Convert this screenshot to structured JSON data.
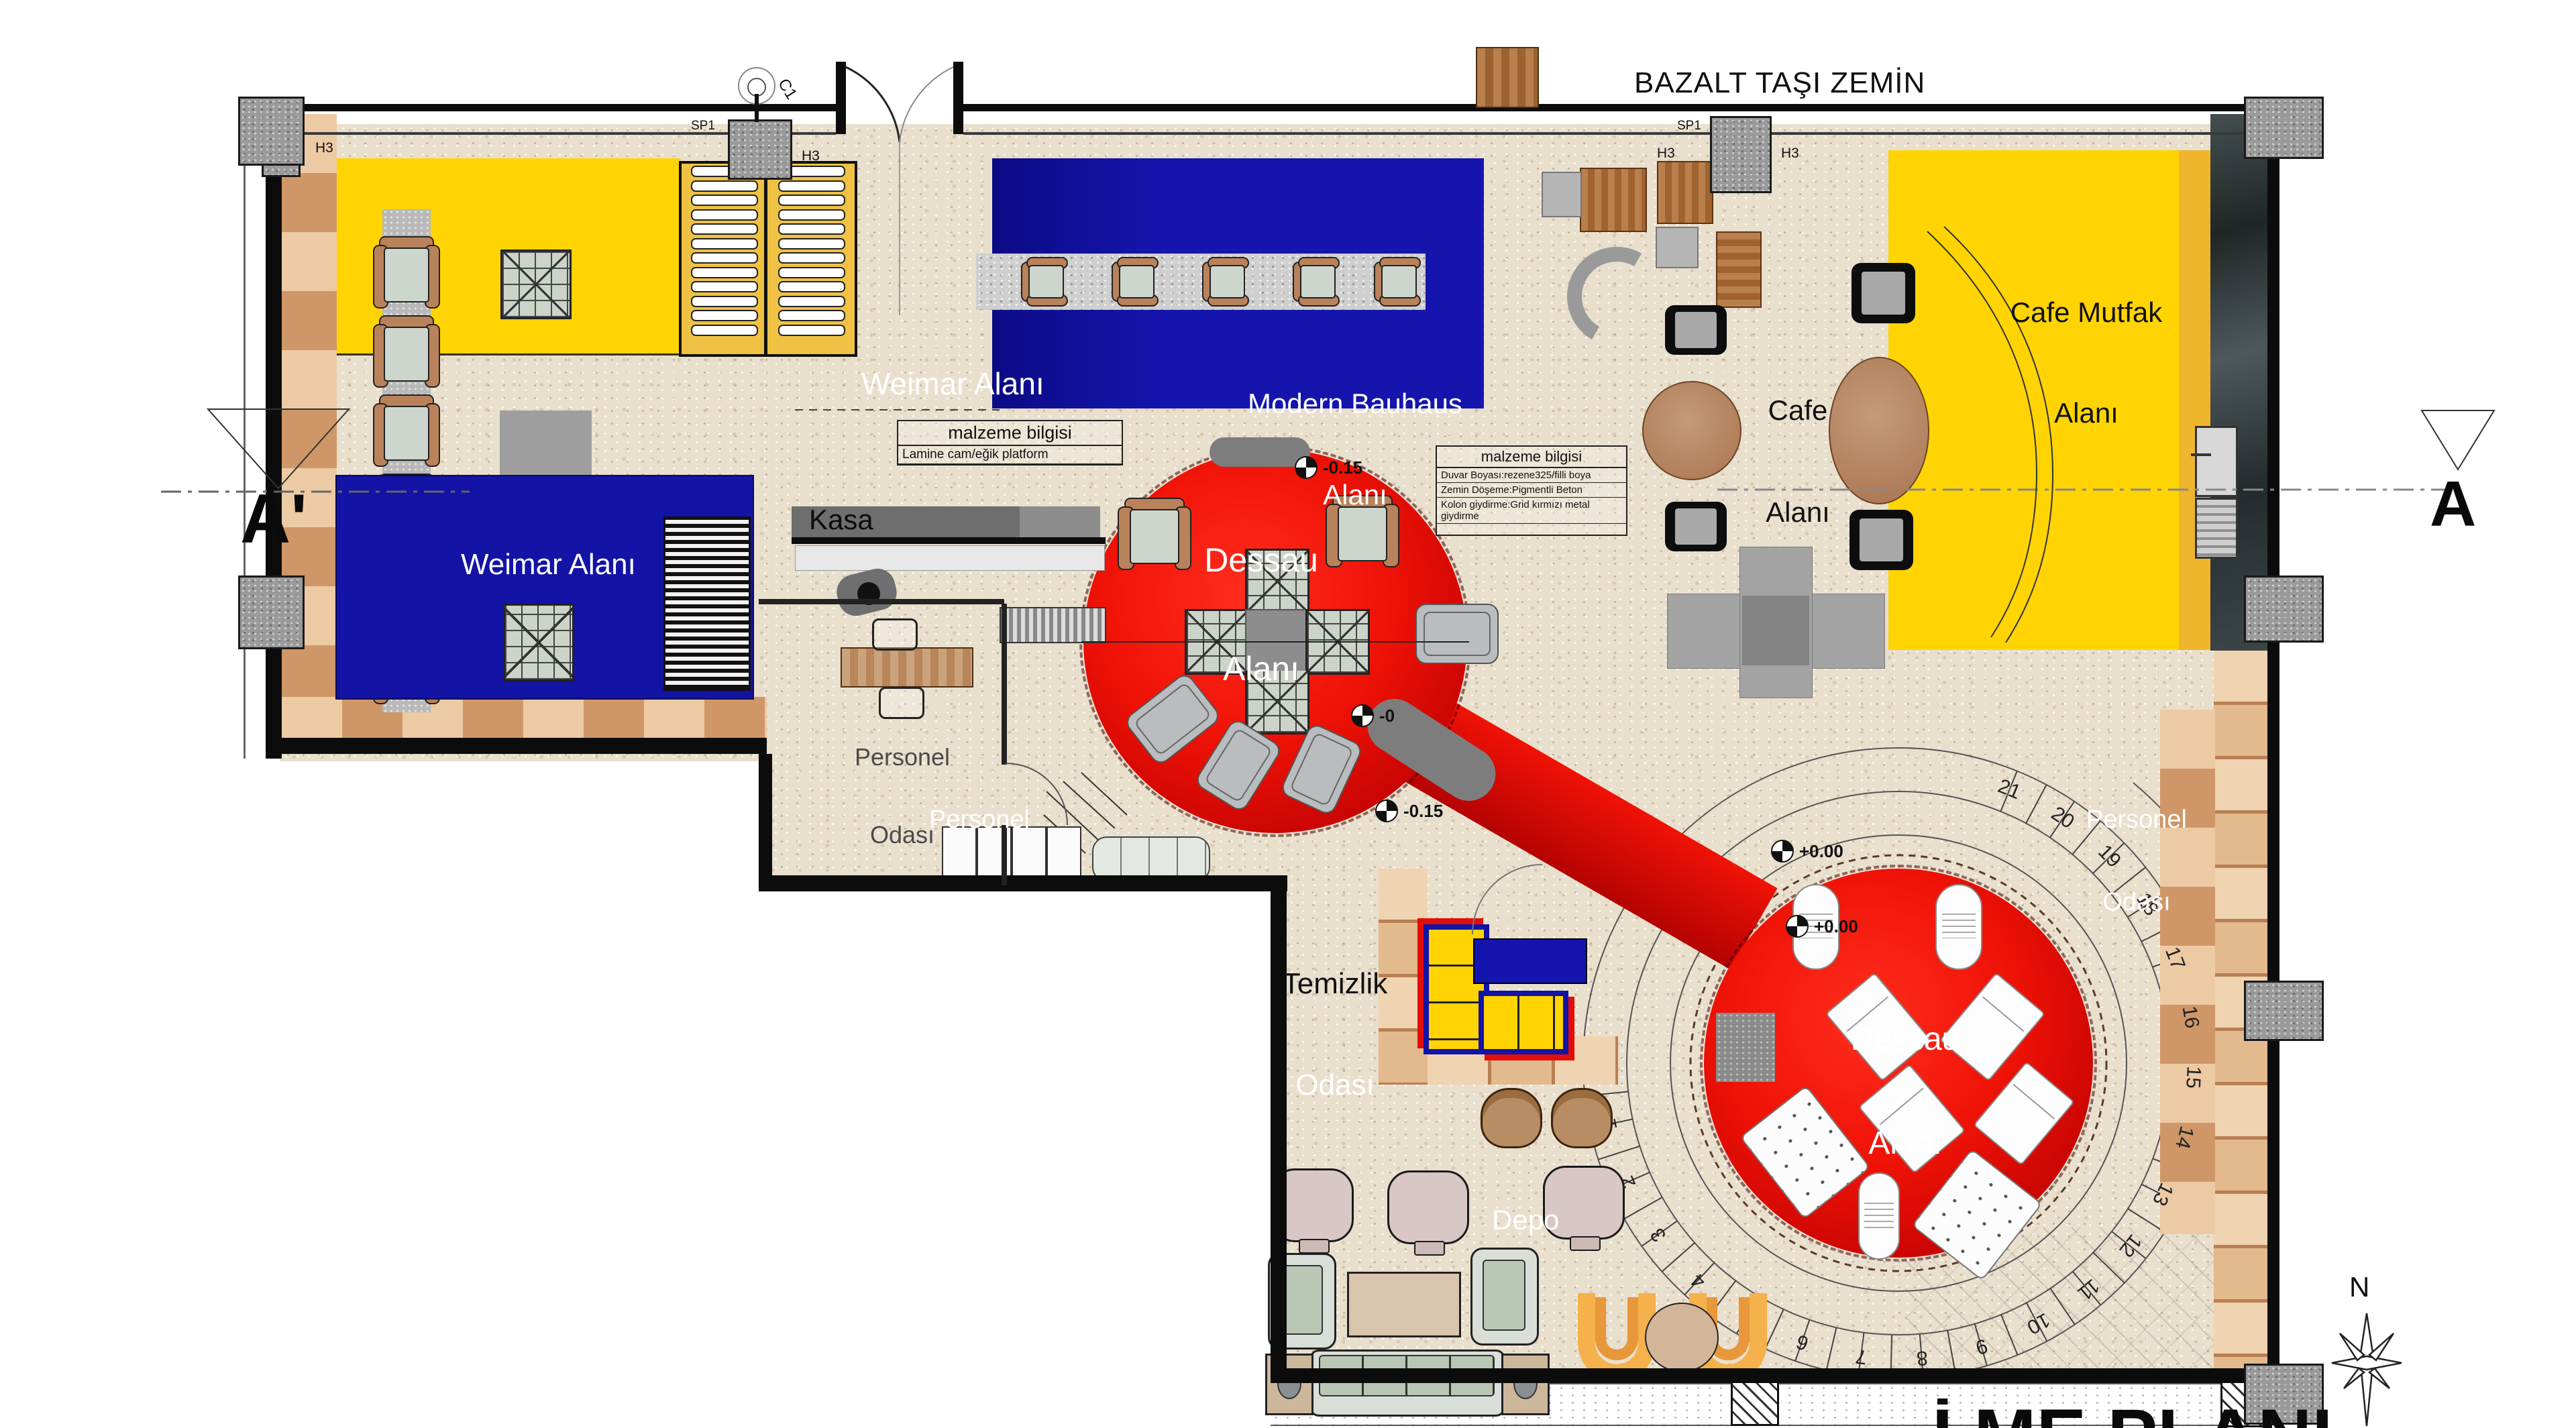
{
  "plan": {
    "floor_note": "BAZALT TAŞI ZEMİN",
    "bottom_title": "İ.ME PLANI",
    "areas": {
      "weimar_entry": "Weimar Alanı",
      "weimar_blue": "Weimar Alanı",
      "modern_line1": "Modern Bauhaus",
      "modern_line2": "Alanı",
      "dessau1_line1": "Dessau",
      "dessau1_line2": "Alanı",
      "dessau2_line1": "Dessau",
      "dessau2_line2": "Alanı",
      "cafe_line1": "Cafe",
      "cafe_line2": "Alanı",
      "mutfak_line1": "Cafe Mutfak",
      "mutfak_line2": "Alanı",
      "personel1_line1": "Personel",
      "personel1_line2": "Odası",
      "personel2_line1": "Personel",
      "personel2_line2": "Odası",
      "personel3_line1": "Personel",
      "personel3_line2": "Odası",
      "temizlik_line1": "Temizlik",
      "temizlik_line2": "Odası",
      "depo": "Depo",
      "kasa": "Kasa"
    },
    "material_table_1": {
      "header": "malzeme bilgisi",
      "rows": [
        "Lamine cam/eğik platform"
      ]
    },
    "material_table_2": {
      "header": "malzeme bilgisi",
      "rows": [
        "Duvar Boyası:rezene325/filli boya",
        "Zemin Döşeme:Pigmentli Beton",
        "Kolon giydirme:Grid kırmızı metal giydirme"
      ]
    },
    "section_markers": {
      "left": "A'",
      "right": "A"
    },
    "north_label": "N",
    "column_labels": {
      "c1": "C1",
      "h3": "H3",
      "sp": "SP1"
    },
    "level_markers": [
      {
        "value": "-0.15"
      },
      {
        "value": "-0"
      },
      {
        "value": "-0.15"
      },
      {
        "value": "+0.00"
      },
      {
        "value": "+0.00"
      }
    ],
    "ramp_numbers": [
      1,
      2,
      3,
      4,
      5,
      6,
      7,
      8,
      9,
      10,
      11,
      12,
      13,
      14,
      15,
      16,
      17,
      18,
      19,
      20,
      21
    ],
    "colors": {
      "bauhaus_yellow": "#FFD402",
      "bauhaus_blue": "#1313A5",
      "bauhaus_red": "#E30D09",
      "stone_floor": "#E9DFCD",
      "wood": "#D9A878",
      "wall": "#0C0C0C"
    }
  }
}
